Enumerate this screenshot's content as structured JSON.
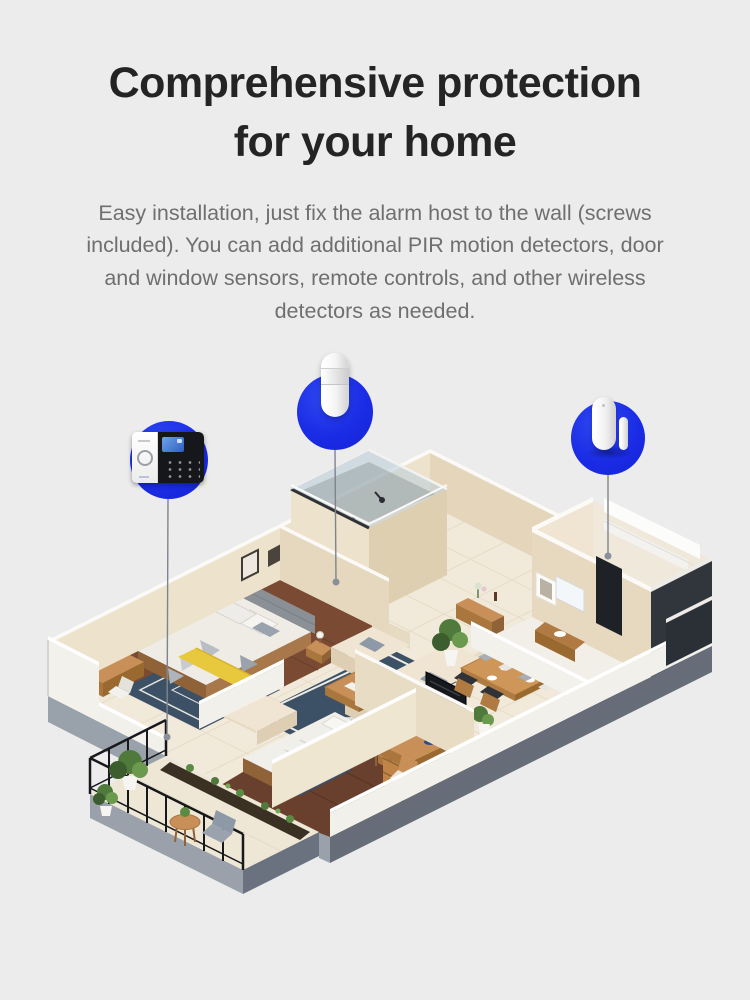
{
  "page": {
    "background_color": "#ECECEC",
    "accent_blue": "#1B2CE5"
  },
  "header": {
    "title_line1": "Comprehensive protection",
    "title_line2": "for your home",
    "description": "Easy installation, just fix the alarm host to the wall (screws included). You can add additional PIR motion detectors, door and window sensors, remote controls, and other wireless detectors as needed."
  },
  "callouts": [
    {
      "name": "alarm-host",
      "icon": "alarm-host-panel-icon"
    },
    {
      "name": "pir-motion-detector",
      "icon": "pir-motion-detector-icon"
    },
    {
      "name": "door-window-sensor",
      "icon": "door-window-sensor-icon"
    }
  ],
  "floorplan": {
    "type": "isometric-apartment-render",
    "rooms": [
      "master-bedroom",
      "shower-room",
      "kitchen",
      "bathroom",
      "entry",
      "living-room",
      "dining-area",
      "second-bedroom",
      "study",
      "balcony"
    ]
  }
}
